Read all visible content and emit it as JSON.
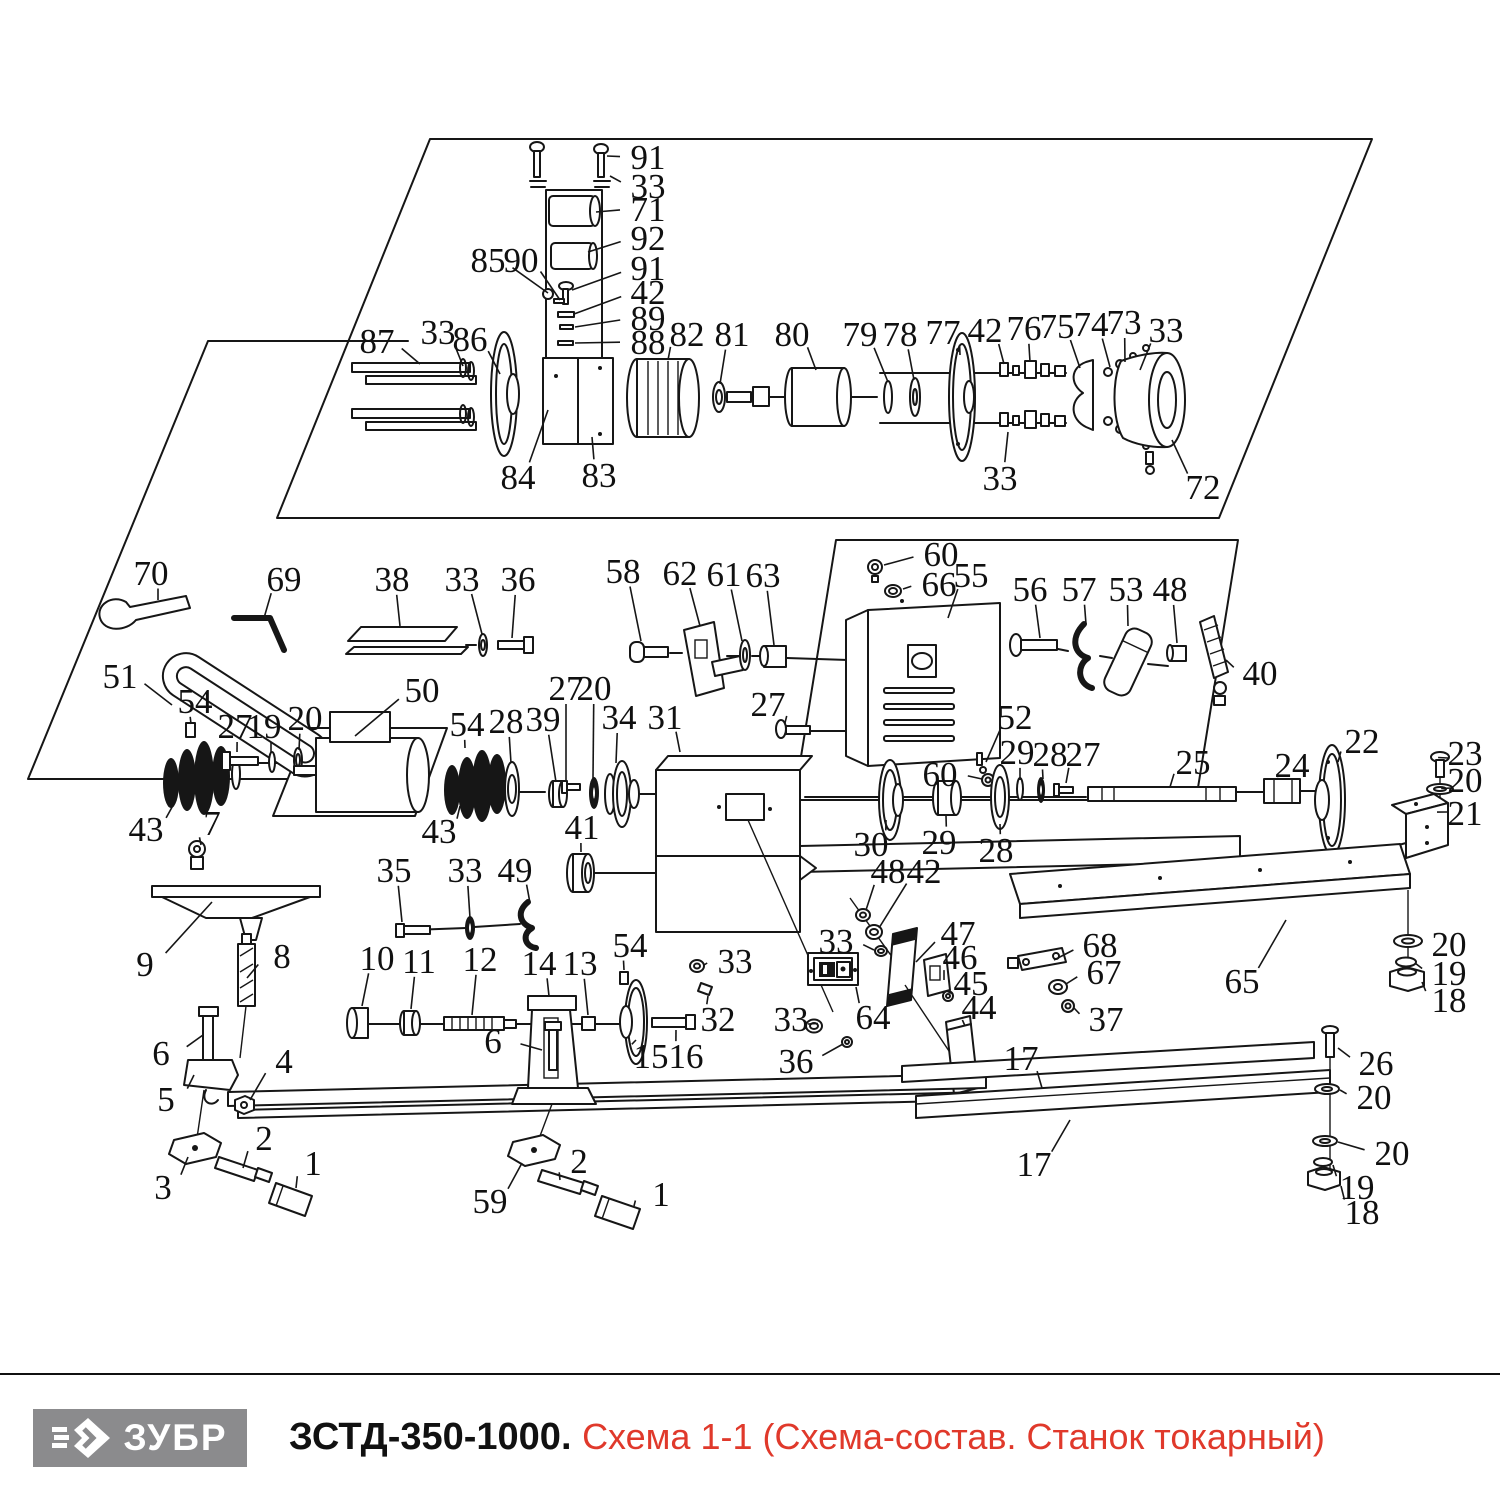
{
  "footer": {
    "brand": "ЗУБР",
    "model": "ЗСТД-350-1000.",
    "subtitle": "Схема 1-1 (Схема-состав. Станок токарный)",
    "accent_color": "#e0392b",
    "logo_bg": "#8b8b8d"
  },
  "diagram": {
    "stroke_color": "#161616",
    "label_font_size": 35,
    "labels": [
      {
        "t": "91",
        "x": 648,
        "y": 157,
        "tx": 607,
        "ty": 156
      },
      {
        "t": "33",
        "x": 648,
        "y": 186,
        "tx": 610,
        "ty": 176
      },
      {
        "t": "71",
        "x": 648,
        "y": 209,
        "tx": 596,
        "ty": 212
      },
      {
        "t": "92",
        "x": 648,
        "y": 238,
        "tx": 588,
        "ty": 252
      },
      {
        "t": "85",
        "x": 488,
        "y": 260,
        "tx": 548,
        "ty": 293
      },
      {
        "t": "90",
        "x": 521,
        "y": 260,
        "tx": 560,
        "ty": 300
      },
      {
        "t": "91",
        "x": 648,
        "y": 268,
        "tx": 572,
        "ty": 290
      },
      {
        "t": "42",
        "x": 648,
        "y": 292,
        "tx": 574,
        "ty": 314
      },
      {
        "t": "89",
        "x": 648,
        "y": 318,
        "tx": 575,
        "ty": 327
      },
      {
        "t": "88",
        "x": 648,
        "y": 342,
        "tx": 575,
        "ty": 343
      },
      {
        "t": "87",
        "x": 377,
        "y": 341,
        "tx": 420,
        "ty": 364
      },
      {
        "t": "33",
        "x": 438,
        "y": 332,
        "tx": 463,
        "ty": 366
      },
      {
        "t": "86",
        "x": 470,
        "y": 339,
        "tx": 500,
        "ty": 374
      },
      {
        "t": "82",
        "x": 687,
        "y": 334,
        "tx": 668,
        "ty": 360
      },
      {
        "t": "81",
        "x": 732,
        "y": 334,
        "tx": 720,
        "ty": 384
      },
      {
        "t": "80",
        "x": 792,
        "y": 334,
        "tx": 816,
        "ty": 370
      },
      {
        "t": "79",
        "x": 860,
        "y": 334,
        "tx": 888,
        "ty": 382
      },
      {
        "t": "78",
        "x": 900,
        "y": 334,
        "tx": 914,
        "ty": 380
      },
      {
        "t": "77",
        "x": 943,
        "y": 332,
        "tx": 960,
        "ty": 355
      },
      {
        "t": "42",
        "x": 985,
        "y": 330,
        "tx": 1004,
        "ty": 364
      },
      {
        "t": "76",
        "x": 1024,
        "y": 328,
        "tx": 1030,
        "ty": 362
      },
      {
        "t": "75",
        "x": 1057,
        "y": 326,
        "tx": 1080,
        "ty": 368
      },
      {
        "t": "74",
        "x": 1091,
        "y": 324,
        "tx": 1110,
        "ty": 367
      },
      {
        "t": "73",
        "x": 1124,
        "y": 322,
        "tx": 1125,
        "ty": 362
      },
      {
        "t": "33",
        "x": 1166,
        "y": 330,
        "tx": 1140,
        "ty": 370
      },
      {
        "t": "33",
        "x": 1000,
        "y": 478,
        "tx": 1008,
        "ty": 432
      },
      {
        "t": "72",
        "x": 1203,
        "y": 487,
        "tx": 1172,
        "ty": 440
      },
      {
        "t": "84",
        "x": 518,
        "y": 477,
        "tx": 548,
        "ty": 410
      },
      {
        "t": "83",
        "x": 599,
        "y": 475,
        "tx": 592,
        "ty": 437
      },
      {
        "t": "70",
        "x": 151,
        "y": 573,
        "tx": 158,
        "ty": 600
      },
      {
        "t": "69",
        "x": 284,
        "y": 579,
        "tx": 264,
        "ty": 618
      },
      {
        "t": "38",
        "x": 392,
        "y": 579,
        "tx": 400,
        "ty": 626
      },
      {
        "t": "33",
        "x": 462,
        "y": 579,
        "tx": 482,
        "ty": 634
      },
      {
        "t": "36",
        "x": 518,
        "y": 579,
        "tx": 512,
        "ty": 638
      },
      {
        "t": "58",
        "x": 623,
        "y": 571,
        "tx": 641,
        "ty": 641
      },
      {
        "t": "62",
        "x": 680,
        "y": 573,
        "tx": 700,
        "ty": 626
      },
      {
        "t": "61",
        "x": 724,
        "y": 574,
        "tx": 742,
        "ty": 641
      },
      {
        "t": "63",
        "x": 763,
        "y": 575,
        "tx": 774,
        "ty": 645
      },
      {
        "t": "60",
        "x": 941,
        "y": 554,
        "tx": 884,
        "ty": 565
      },
      {
        "t": "66",
        "x": 939,
        "y": 584,
        "tx": 903,
        "ty": 589
      },
      {
        "t": "55",
        "x": 971,
        "y": 575,
        "tx": 948,
        "ty": 618
      },
      {
        "t": "56",
        "x": 1030,
        "y": 589,
        "tx": 1040,
        "ty": 638
      },
      {
        "t": "57",
        "x": 1079,
        "y": 589,
        "tx": 1086,
        "ty": 624
      },
      {
        "t": "53",
        "x": 1126,
        "y": 589,
        "tx": 1128,
        "ty": 626
      },
      {
        "t": "48",
        "x": 1170,
        "y": 589,
        "tx": 1177,
        "ty": 643
      },
      {
        "t": "40",
        "x": 1260,
        "y": 673,
        "tx": 1226,
        "ty": 660
      },
      {
        "t": "51",
        "x": 120,
        "y": 676,
        "tx": 172,
        "ty": 705
      },
      {
        "t": "54",
        "x": 195,
        "y": 701,
        "tx": 191,
        "ty": 724
      },
      {
        "t": "27",
        "x": 235,
        "y": 726,
        "tx": 237,
        "ty": 752
      },
      {
        "t": "19",
        "x": 264,
        "y": 726,
        "tx": 271,
        "ty": 753
      },
      {
        "t": "20",
        "x": 305,
        "y": 718,
        "tx": 299,
        "ty": 750
      },
      {
        "t": "50",
        "x": 422,
        "y": 690,
        "tx": 355,
        "ty": 736
      },
      {
        "t": "54",
        "x": 467,
        "y": 724,
        "tx": 465,
        "ty": 748
      },
      {
        "t": "28",
        "x": 506,
        "y": 721,
        "tx": 511,
        "ty": 763
      },
      {
        "t": "39",
        "x": 543,
        "y": 719,
        "tx": 556,
        "ty": 782
      },
      {
        "t": "27",
        "x": 566,
        "y": 688,
        "tx": 566,
        "ty": 780
      },
      {
        "t": "20",
        "x": 594,
        "y": 688,
        "tx": 593,
        "ty": 778
      },
      {
        "t": "34",
        "x": 619,
        "y": 717,
        "tx": 616,
        "ty": 763
      },
      {
        "t": "31",
        "x": 665,
        "y": 717,
        "tx": 680,
        "ty": 752
      },
      {
        "t": "27",
        "x": 768,
        "y": 704,
        "tx": 785,
        "ty": 723
      },
      {
        "t": "52",
        "x": 1015,
        "y": 717,
        "tx": 986,
        "ty": 762
      },
      {
        "t": "60",
        "x": 940,
        "y": 774,
        "tx": 982,
        "ty": 779
      },
      {
        "t": "29",
        "x": 1017,
        "y": 752,
        "tx": 1020,
        "ty": 780
      },
      {
        "t": "28",
        "x": 1050,
        "y": 754,
        "tx": 1043,
        "ty": 779
      },
      {
        "t": "27",
        "x": 1083,
        "y": 754,
        "tx": 1066,
        "ty": 783
      },
      {
        "t": "25",
        "x": 1193,
        "y": 762,
        "tx": 1170,
        "ty": 787
      },
      {
        "t": "24",
        "x": 1292,
        "y": 765,
        "tx": 1283,
        "ty": 779
      },
      {
        "t": "22",
        "x": 1362,
        "y": 741,
        "tx": 1338,
        "ty": 762
      },
      {
        "t": "23",
        "x": 1465,
        "y": 753,
        "tx": 1448,
        "ty": 758
      },
      {
        "t": "20",
        "x": 1465,
        "y": 780,
        "tx": 1452,
        "ty": 788
      },
      {
        "t": "21",
        "x": 1465,
        "y": 813,
        "tx": 1447,
        "ty": 812
      },
      {
        "t": "43",
        "x": 146,
        "y": 829,
        "tx": 176,
        "ty": 800
      },
      {
        "t": "7",
        "x": 212,
        "y": 823,
        "tx": 201,
        "ty": 845
      },
      {
        "t": "43",
        "x": 439,
        "y": 831,
        "tx": 460,
        "ty": 806
      },
      {
        "t": "41",
        "x": 582,
        "y": 827,
        "tx": 581,
        "ty": 852
      },
      {
        "t": "30",
        "x": 871,
        "y": 844,
        "tx": 886,
        "ty": 820
      },
      {
        "t": "29",
        "x": 939,
        "y": 842,
        "tx": 946,
        "ty": 816
      },
      {
        "t": "28",
        "x": 996,
        "y": 850,
        "tx": 1000,
        "ty": 824
      },
      {
        "t": "48",
        "x": 888,
        "y": 871,
        "tx": 866,
        "ty": 910
      },
      {
        "t": "42",
        "x": 924,
        "y": 871,
        "tx": 879,
        "ty": 928
      },
      {
        "t": "33",
        "x": 836,
        "y": 941,
        "tx": 874,
        "ty": 950
      },
      {
        "t": "35",
        "x": 394,
        "y": 870,
        "tx": 402,
        "ty": 922
      },
      {
        "t": "33",
        "x": 465,
        "y": 870,
        "tx": 470,
        "ty": 918
      },
      {
        "t": "49",
        "x": 515,
        "y": 870,
        "tx": 530,
        "ty": 903
      },
      {
        "t": "9",
        "x": 145,
        "y": 964,
        "tx": 212,
        "ty": 902
      },
      {
        "t": "8",
        "x": 282,
        "y": 956,
        "tx": 247,
        "ty": 978
      },
      {
        "t": "47",
        "x": 958,
        "y": 933,
        "tx": 916,
        "ty": 962
      },
      {
        "t": "46",
        "x": 960,
        "y": 957,
        "tx": 944,
        "ty": 980
      },
      {
        "t": "45",
        "x": 971,
        "y": 983,
        "tx": 953,
        "ty": 994
      },
      {
        "t": "68",
        "x": 1100,
        "y": 945,
        "tx": 1054,
        "ty": 960
      },
      {
        "t": "67",
        "x": 1104,
        "y": 972,
        "tx": 1066,
        "ty": 984
      },
      {
        "t": "37",
        "x": 1106,
        "y": 1019,
        "tx": 1074,
        "ty": 1008
      },
      {
        "t": "44",
        "x": 979,
        "y": 1007,
        "tx": 965,
        "ty": 1026
      },
      {
        "t": "65",
        "x": 1242,
        "y": 981,
        "tx": 1286,
        "ty": 920
      },
      {
        "t": "20",
        "x": 1449,
        "y": 944,
        "tx": 1421,
        "ty": 942
      },
      {
        "t": "19",
        "x": 1449,
        "y": 973,
        "tx": 1415,
        "ty": 963
      },
      {
        "t": "18",
        "x": 1449,
        "y": 1000,
        "tx": 1422,
        "ty": 982
      },
      {
        "t": "10",
        "x": 377,
        "y": 958,
        "tx": 362,
        "ty": 1006
      },
      {
        "t": "11",
        "x": 419,
        "y": 961,
        "tx": 411,
        "ty": 1009
      },
      {
        "t": "12",
        "x": 480,
        "y": 959,
        "tx": 472,
        "ty": 1015
      },
      {
        "t": "14",
        "x": 539,
        "y": 963,
        "tx": 549,
        "ty": 996
      },
      {
        "t": "13",
        "x": 580,
        "y": 963,
        "tx": 588,
        "ty": 1015
      },
      {
        "t": "54",
        "x": 630,
        "y": 945,
        "tx": 624,
        "ty": 970
      },
      {
        "t": "33",
        "x": 735,
        "y": 961,
        "tx": 704,
        "ty": 965
      },
      {
        "t": "32",
        "x": 718,
        "y": 1019,
        "tx": 708,
        "ty": 996
      },
      {
        "t": "33",
        "x": 791,
        "y": 1019,
        "tx": 808,
        "ty": 1024
      },
      {
        "t": "64",
        "x": 873,
        "y": 1017,
        "tx": 856,
        "ty": 987
      },
      {
        "t": "15",
        "x": 651,
        "y": 1056,
        "tx": 636,
        "ty": 1040
      },
      {
        "t": "16",
        "x": 686,
        "y": 1056,
        "tx": 676,
        "ty": 1030
      },
      {
        "t": "36",
        "x": 796,
        "y": 1061,
        "tx": 843,
        "ty": 1044
      },
      {
        "t": "6",
        "x": 161,
        "y": 1053,
        "tx": 203,
        "ty": 1035
      },
      {
        "t": "6",
        "x": 493,
        "y": 1041,
        "tx": 542,
        "ty": 1050
      },
      {
        "t": "5",
        "x": 166,
        "y": 1099,
        "tx": 194,
        "ty": 1075
      },
      {
        "t": "4",
        "x": 284,
        "y": 1061,
        "tx": 250,
        "ty": 1100
      },
      {
        "t": "17",
        "x": 1021,
        "y": 1058,
        "tx": 1042,
        "ty": 1088
      },
      {
        "t": "26",
        "x": 1376,
        "y": 1063,
        "tx": 1338,
        "ty": 1048
      },
      {
        "t": "20",
        "x": 1374,
        "y": 1097,
        "tx": 1340,
        "ty": 1090
      },
      {
        "t": "2",
        "x": 264,
        "y": 1138,
        "tx": 243,
        "ty": 1168
      },
      {
        "t": "3",
        "x": 163,
        "y": 1187,
        "tx": 188,
        "ty": 1157
      },
      {
        "t": "1",
        "x": 313,
        "y": 1163,
        "tx": 296,
        "ty": 1188
      },
      {
        "t": "59",
        "x": 490,
        "y": 1201,
        "tx": 522,
        "ty": 1163
      },
      {
        "t": "2",
        "x": 579,
        "y": 1161,
        "tx": 560,
        "ty": 1180
      },
      {
        "t": "1",
        "x": 661,
        "y": 1194,
        "tx": 634,
        "ty": 1206
      },
      {
        "t": "17",
        "x": 1034,
        "y": 1164,
        "tx": 1070,
        "ty": 1120
      },
      {
        "t": "20",
        "x": 1392,
        "y": 1153,
        "tx": 1338,
        "ty": 1142
      },
      {
        "t": "19",
        "x": 1357,
        "y": 1187,
        "tx": 1333,
        "ty": 1165
      },
      {
        "t": "18",
        "x": 1362,
        "y": 1212,
        "tx": 1341,
        "ty": 1186
      }
    ]
  }
}
